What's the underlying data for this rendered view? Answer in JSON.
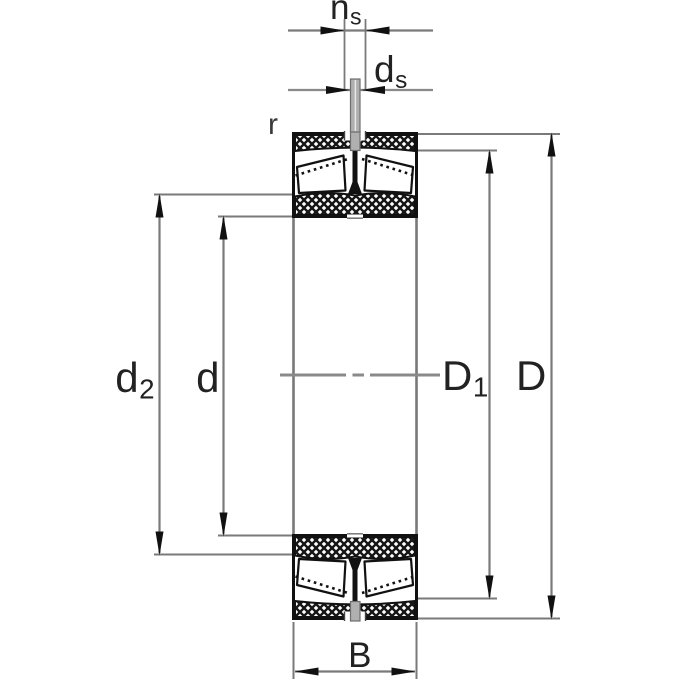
{
  "drawing": {
    "type": "bearing-cross-section-dimension-diagram",
    "labels": {
      "groove_width": {
        "base": "n",
        "sub": "s"
      },
      "hole_diameter": {
        "base": "d",
        "sub": "s"
      },
      "chamfer": {
        "text": "r"
      },
      "recess_diameter": {
        "base": "d",
        "sub": "2"
      },
      "bore_diameter": {
        "text": "d"
      },
      "shoulder_diameter": {
        "base": "D",
        "sub": "1"
      },
      "outside_diameter": {
        "text": "D"
      },
      "width": {
        "text": "B"
      }
    },
    "colors": {
      "background": "#ffffff",
      "ink": "#111111",
      "dimension_line_gray": "#7a7a7a",
      "centerline_gray": "#8a8a8a",
      "lubrication_pin_gray": "#b0b0b0",
      "label_text": "#222222"
    }
  }
}
